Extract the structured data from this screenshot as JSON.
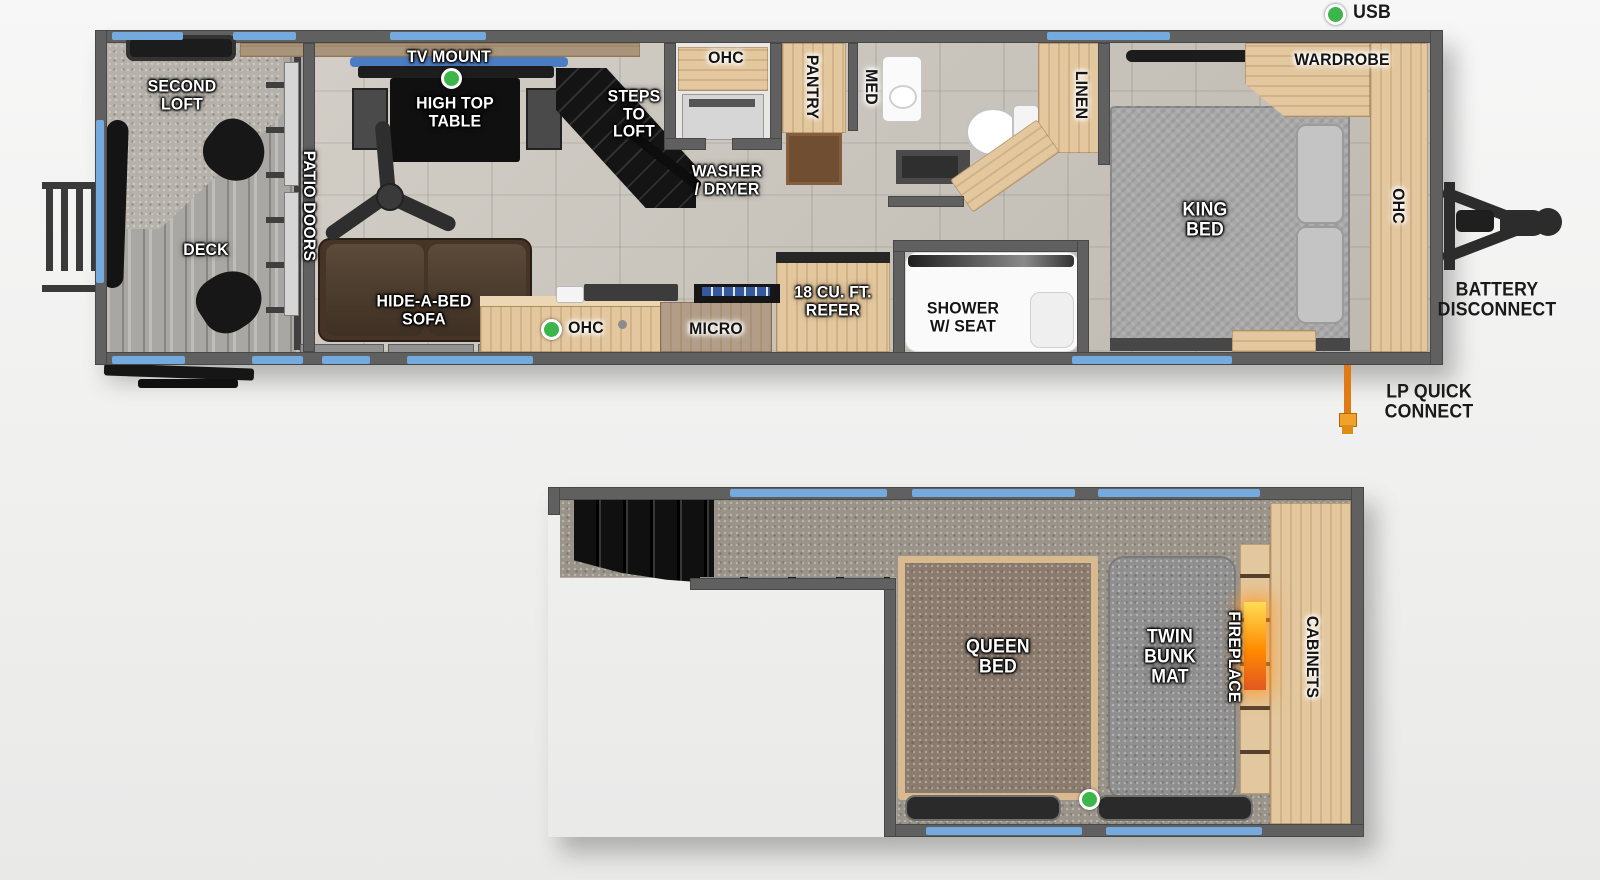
{
  "colors": {
    "wall": "#606060",
    "window_trim": "#74aadd",
    "indicator_dot": "#3cb54b",
    "wood_light": "#e3c79e",
    "fire_glow": "#ff8a00",
    "lp_hose": "#df7a16"
  },
  "main_floor": {
    "second_loft": [
      "SECOND",
      "LOFT"
    ],
    "deck": "DECK",
    "patio_doors": "PATIO DOORS",
    "tv_mount": "TV MOUNT",
    "high_top_table": [
      "HIGH TOP",
      "TABLE"
    ],
    "steps_to_loft": [
      "STEPS",
      "TO",
      "LOFT"
    ],
    "hide_a_bed_sofa": [
      "HIDE-A-BED",
      "SOFA"
    ],
    "kitchen_ohc": "OHC",
    "micro": "MICRO",
    "refer": [
      "18 CU. FT.",
      "REFER"
    ],
    "closet_ohc": "OHC",
    "washer_dryer": [
      "WASHER",
      "/ DRYER"
    ],
    "pantry": "PANTRY",
    "med": "MED",
    "linen": "LINEN",
    "shower": [
      "SHOWER",
      "W/ SEAT"
    ],
    "king_bed": [
      "KING",
      "BED"
    ],
    "wardrobe": "WARDROBE",
    "bedroom_ohc": "OHC"
  },
  "exterior": {
    "usb": "USB",
    "battery_disconnect": [
      "BATTERY",
      "DISCONNECT"
    ],
    "lp_quick_connect": [
      "LP QUICK",
      "CONNECT"
    ]
  },
  "loft_floor": {
    "queen_bed": [
      "QUEEN",
      "BED"
    ],
    "twin_bunk_mat": [
      "TWIN",
      "BUNK",
      "MAT"
    ],
    "fireplace": "FIREPLACE",
    "cabinets": "CABINETS"
  }
}
